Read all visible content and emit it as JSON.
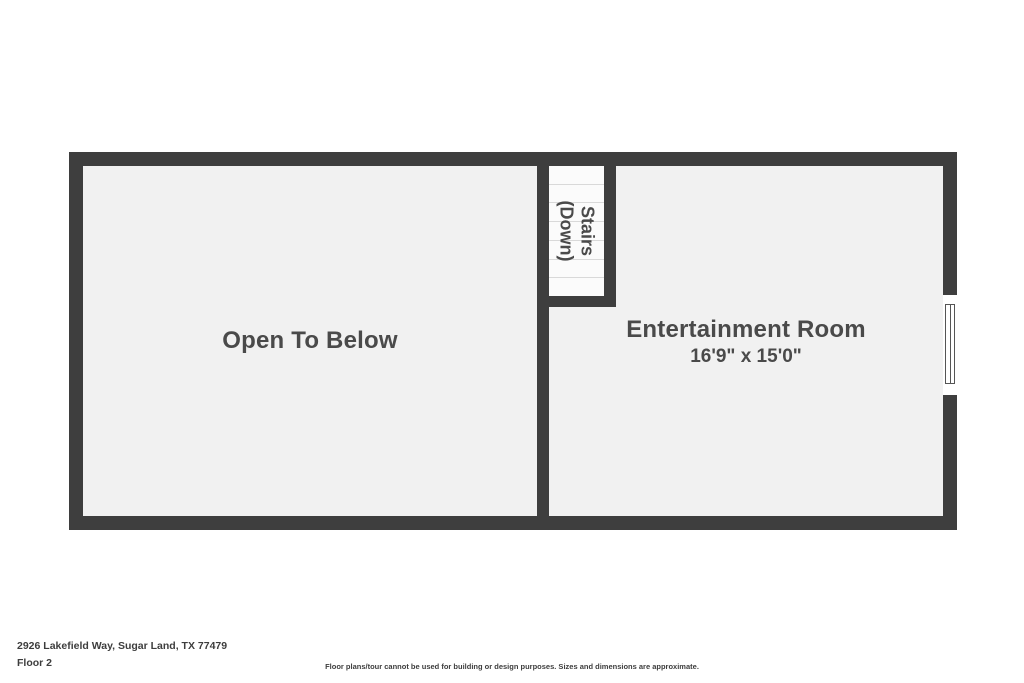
{
  "colors": {
    "wall": "#3e3e3e",
    "room_fill": "#f1f1f1",
    "stairs_fill": "#fbfbfb",
    "tread_line": "#d9d9d9",
    "text": "#4a4a4a",
    "window_fill": "#ffffff"
  },
  "floorplan": {
    "open_room": {
      "label": "Open To Below"
    },
    "entertainment_room": {
      "label": "Entertainment Room",
      "dimensions": "16'9\" x 15'0\""
    },
    "stairs": {
      "line1": "Stairs",
      "line2": "(Down)",
      "steps": 7
    }
  },
  "footer": {
    "address": "2926 Lakefield Way, Sugar Land, TX 77479",
    "floor_label": "Floor 2",
    "disclaimer": "Floor plans/tour cannot be used for building or design purposes. Sizes and dimensions are approximate."
  }
}
